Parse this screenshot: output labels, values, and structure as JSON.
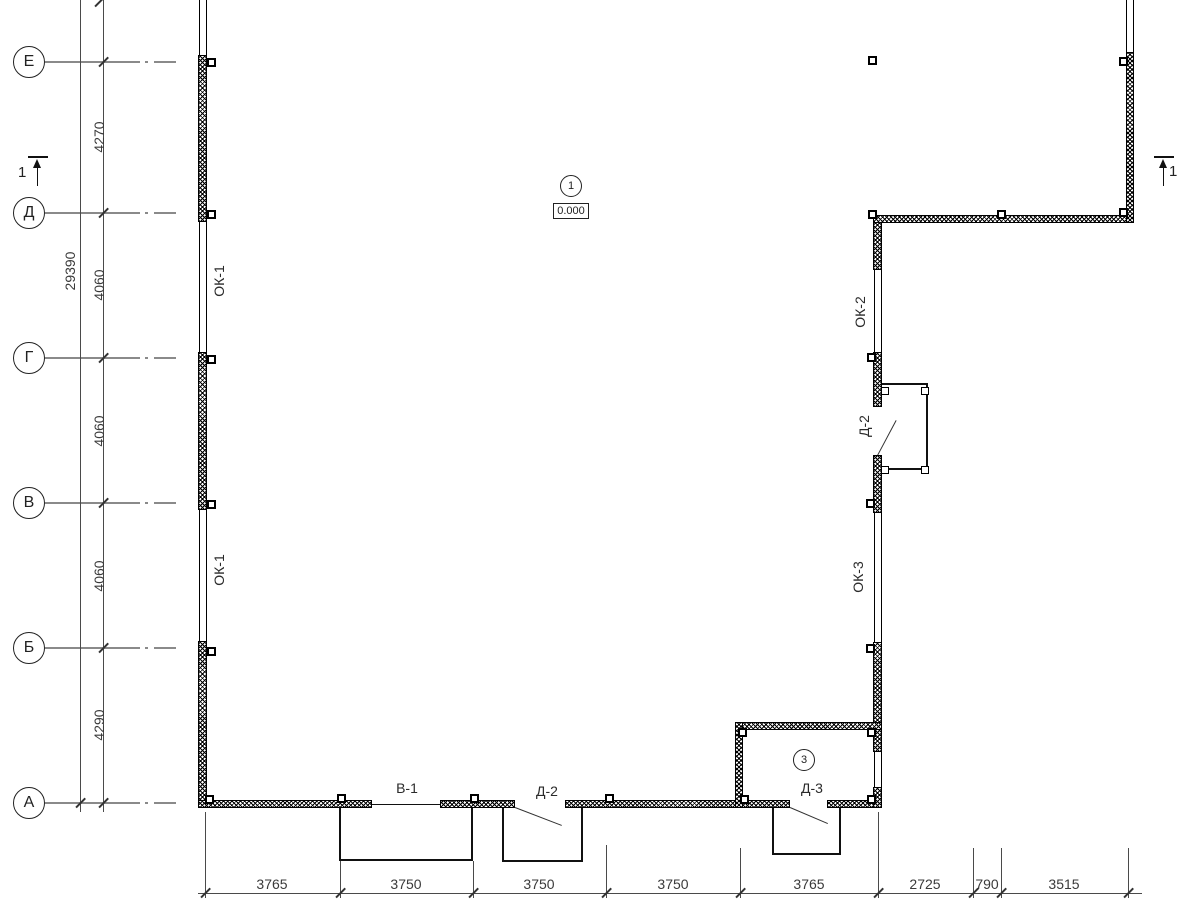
{
  "drawing": {
    "type": "architectural floor plan"
  },
  "axes": {
    "row_labels": [
      "Е",
      "Д",
      "Г",
      "В",
      "Б",
      "А"
    ]
  },
  "dims_left": {
    "overall": "29390",
    "segments": [
      "4270",
      "4060",
      "4060",
      "4060",
      "4290"
    ]
  },
  "dims_bottom": [
    "3765",
    "3750",
    "3750",
    "3750",
    "3765",
    "2725",
    "790",
    "3515"
  ],
  "labels": {
    "ok1_upper": "ОК-1",
    "ok1_lower": "ОК-1",
    "ok2": "ОК-2",
    "ok3": "ОК-3",
    "d2_wall": "Д-2",
    "v1": "В-1",
    "d2_bottom": "Д-2",
    "d3": "Д-3"
  },
  "markers": {
    "plan_node": "1",
    "level": "0.000",
    "room_node": "3",
    "section_left": "1",
    "section_right": "1"
  }
}
